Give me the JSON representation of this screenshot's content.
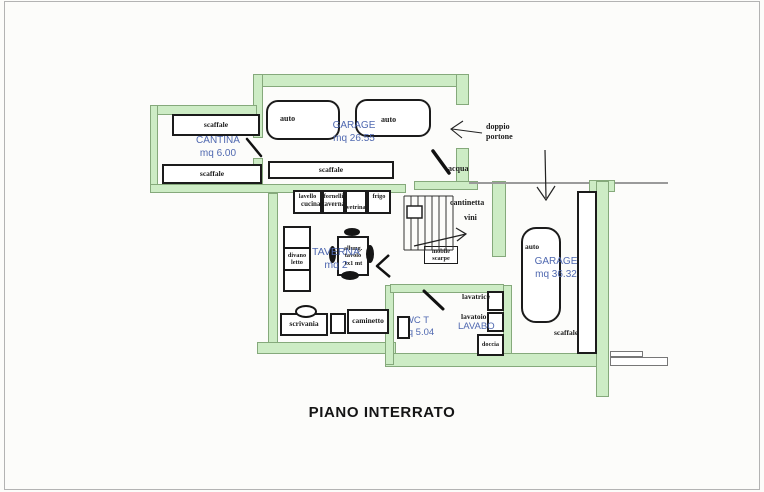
{
  "title": "PIANO INTERRATO",
  "colors": {
    "wall_fill": "#cdecc5",
    "wall_border": "#85a97b",
    "room_label_blue": "#4f68b0",
    "furniture_border": "#1b1b1b"
  },
  "rooms": {
    "cantina": {
      "name": "CANTINA",
      "area": "mq 6.00"
    },
    "garage_top": {
      "name": "GARAGE",
      "area": "mq 26.55"
    },
    "taverna": {
      "name": "TAVERNA",
      "area": "mq 2"
    },
    "wc": {
      "name": "WC T",
      "area": "mq 5.04"
    },
    "lavabo": {
      "name": "LAVABO"
    },
    "garage_right": {
      "name": "GARAGE",
      "area": "mq 36.32"
    }
  },
  "labels": {
    "scaffale": "scaffale",
    "auto": "auto",
    "lavello": "lavello",
    "fornelli": "fornelli",
    "vetrina": "vetrina",
    "frigo": "frigo",
    "cucina_taverna": "cucina taverna",
    "divano_letto": "divano letto",
    "tavolo": "allung. tavolo 1x1 mt",
    "scrivania": "scrivania",
    "caminetto": "caminetto",
    "cantinetta": "cantinetta",
    "vini": "vini",
    "mobile_scarpe": "mobile scarpe",
    "lavatrice": "lavatrice",
    "lavatoio": "lavatoio",
    "doccia": "doccia",
    "acqua": "acqua",
    "doppio": "doppio",
    "portone": "portone"
  }
}
